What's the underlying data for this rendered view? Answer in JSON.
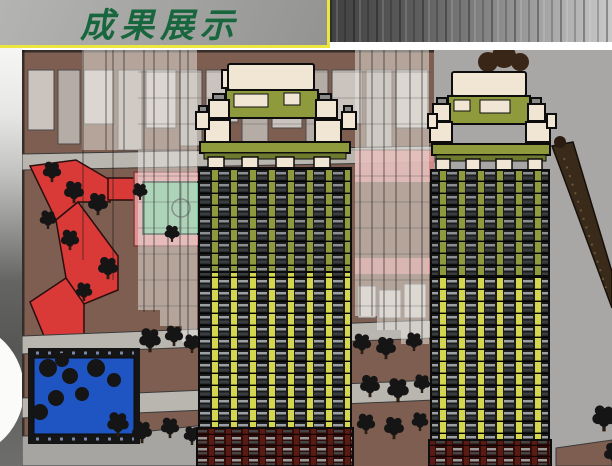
{
  "slide": {
    "title": "成果展示"
  },
  "colors": {
    "title-text": "#17663e",
    "title-box-bg1": "#b4b4b2",
    "title-box-bg2": "#939391",
    "accent-yellow": "#ece73e",
    "metal-dark": "#414141",
    "metal-light": "#c9c9c9",
    "canvas-gray": "#a8a7a5",
    "ground-brown": "#7d5e50",
    "plaza-red": "#d93a38",
    "plaza-pink": "#df9090",
    "court-green": "#6fbd8f",
    "pool-blue": "#1f55c2",
    "path-gray": "#b9b6b0",
    "building-pale": "#cbc3bd",
    "building-pale2": "#b5aca6",
    "tower-olive": "#8f9a3d",
    "tower-yellow": "#d4d64f",
    "tower-cream": "#f1e6d4",
    "tower-maroon": "#5a1b15",
    "window-dark": "#1b1b1b",
    "tree-black": "#151515",
    "road-dark": "#3a2a1a",
    "cap-gray": "#8a8a8a",
    "outline-black": "#0d0d0d"
  }
}
